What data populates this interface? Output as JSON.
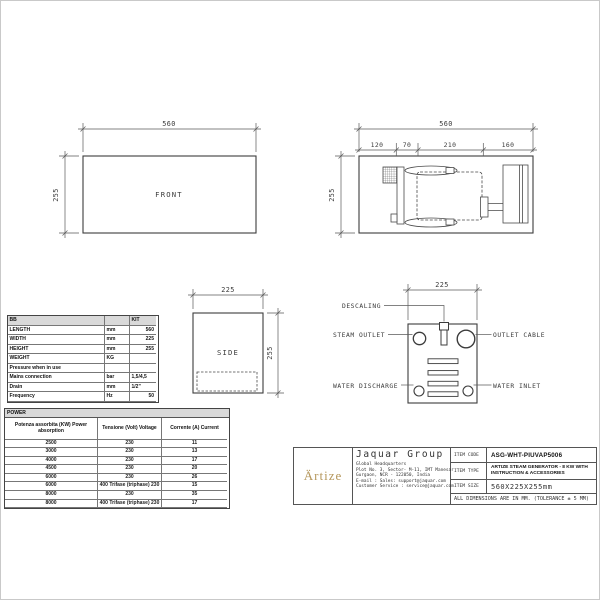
{
  "page": {
    "tolerance_note": "ALL DIMENSIONS ARE IN MM. (TOLERANCE ± 5 MM)"
  },
  "front_view": {
    "label": "FRONT",
    "width_dim": "560",
    "height_dim": "255"
  },
  "top_view": {
    "width_dim": "560",
    "height_dim": "255",
    "segments": [
      "120",
      "70",
      "210",
      "160"
    ]
  },
  "side_view": {
    "label": "SIDE",
    "width_dim": "225",
    "height_dim": "255"
  },
  "panel_view": {
    "width_dim": "225",
    "labels": {
      "descaling": "DESCALING",
      "steam_outlet": "STEAM OUTLET",
      "outlet_cable": "OUTLET CABLE",
      "water_discharge": "WATER DISCHARGE",
      "water_inlet": "WATER INLET"
    }
  },
  "spec_table": {
    "header": {
      "col1": "BB",
      "col2": "",
      "col3": "KIT"
    },
    "rows": [
      {
        "label": "LENGTH",
        "unit": "mm",
        "value": "560"
      },
      {
        "label": "WIDTH",
        "unit": "mm",
        "value": "225"
      },
      {
        "label": "HEIGHT",
        "unit": "mm",
        "value": "255"
      },
      {
        "label": "WEIGHT",
        "unit": "KG",
        "value": ""
      },
      {
        "label": "Pressure when in use",
        "unit": "",
        "value": ""
      },
      {
        "label": "Mains connection",
        "unit": "bar",
        "value": "1,5/4,5"
      },
      {
        "label": "Drain",
        "unit": "mm",
        "value": "1/2\""
      },
      {
        "label": "Frequency",
        "unit": "Hz",
        "value": "50"
      }
    ]
  },
  "power_table": {
    "title": "POWER",
    "headers": [
      "Potenza assorbita (KW) Power absorption",
      "Tensione (Volt) Voltage",
      "Corrente (A) Current"
    ],
    "rows": [
      [
        "2500",
        "230",
        "11"
      ],
      [
        "3000",
        "230",
        "13"
      ],
      [
        "4000",
        "230",
        "17"
      ],
      [
        "4500",
        "230",
        "20"
      ],
      [
        "6000",
        "230",
        "26"
      ],
      [
        "6000",
        "400 Trifase (triphase) 230",
        "15"
      ],
      [
        "8000",
        "230",
        "35"
      ],
      [
        "8000",
        "400 Trifase (triphase) 230",
        "17"
      ]
    ]
  },
  "title_block": {
    "brand": "Ärtize",
    "company": "Jaquar Group",
    "address_lines": [
      "Global Headquarters",
      "Plot No. 3, Sector- M-11, IMT Manesar",
      "Gurgaon, NCR - 122050, India",
      "E-mail : Sales: support@jaquar.com",
      "Customer Service : service@jaquar.com"
    ],
    "item_code_label": "ITEM CODE",
    "item_code": "ASG-WHT-PIUVAP5006",
    "item_type_label": "ITEM TYPE",
    "item_type": "ARTIZE STEAM GENERATOR - 8 KW WITH INSTRUCTION & ACCESSORIES",
    "item_size_label": "ITEM SIZE",
    "item_size": "560X225X255mm"
  },
  "colors": {
    "brand_gold": "#b5975c",
    "line_dark": "#3c3c3c",
    "line_dim": "#5a5a5a",
    "table_header_bg": "#d9d9d9"
  }
}
